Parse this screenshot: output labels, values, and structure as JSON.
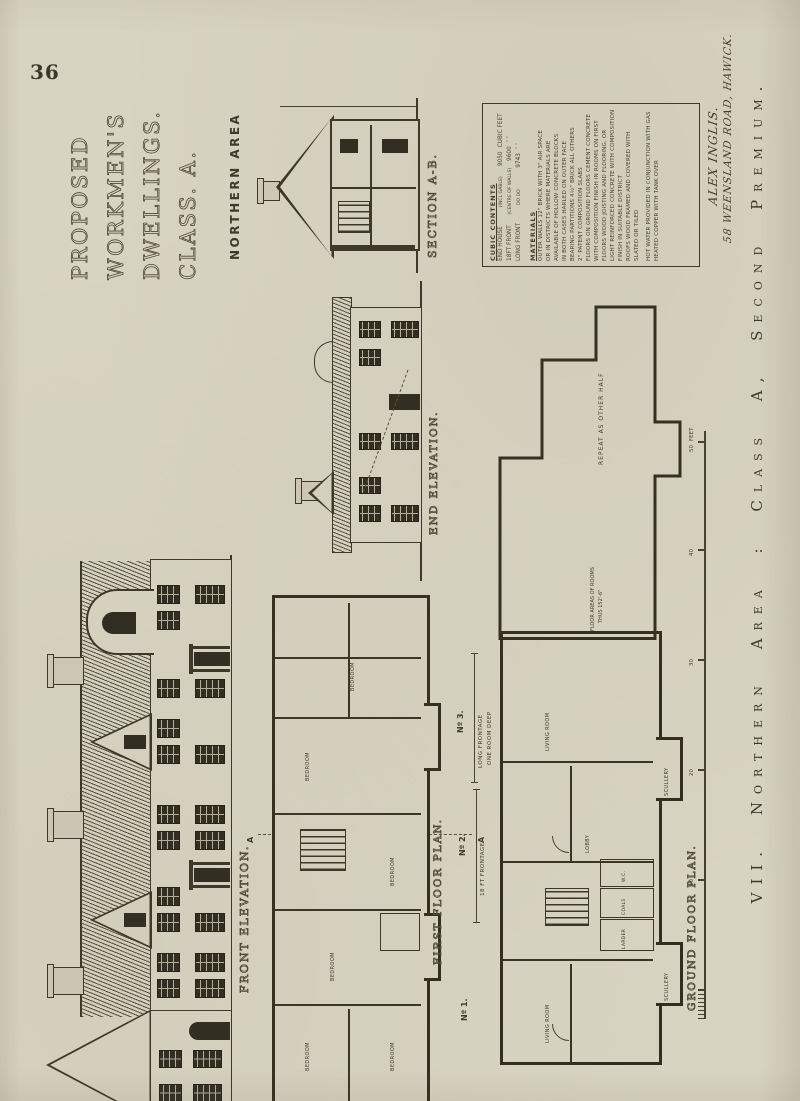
{
  "page_number": "36",
  "colors": {
    "paper": "#d8d4c2",
    "ink": "#3b3628"
  },
  "title_block": {
    "line1": "PROPOSED",
    "line2": "WORKMEN'S",
    "line3": "DWELLINGS.",
    "line4": "CLASS. A.",
    "subtitle": "NORTHERN AREA"
  },
  "labels": {
    "front_elevation": "FRONT ELEVATION.",
    "first_floor_plan": "FIRST FLOOR PLAN.",
    "ground_floor_plan": "GROUND FLOOR PLAN.",
    "end_elevation": "END ELEVATION.",
    "section": "SECTION A-B."
  },
  "house_numbers": {
    "n1": "Nº 1.",
    "n2": "Nº 2.",
    "n3": "Nº 3."
  },
  "dimensions": {
    "frontage_18": "18 FT FRONTAGE",
    "frontage_long": "LONG FRONTAGE",
    "one_room_deep": "ONE ROOM DEEP"
  },
  "plan_notes": {
    "repeat": "REPEAT AS OTHER HALF",
    "floor_areas": "FLOOR AREAS OF ROOMS",
    "floor_areas_value": "THUS 152'-6\""
  },
  "section_marker": "A",
  "rooms": {
    "first_floor": [
      "BEDROOM",
      "BEDROOM",
      "BEDROOM",
      "BEDROOM",
      "BEDROOM",
      "BEDROOM"
    ],
    "ground_floor": [
      "LIVING ROOM",
      "SCULLERY",
      "LARDER",
      "COALS",
      "W.C.",
      "LOBBY",
      "LIVING ROOM",
      "SCULLERY"
    ]
  },
  "scale_bar": {
    "t10": "10",
    "t20": "20",
    "t30": "30",
    "t40": "40",
    "t50": "50",
    "unit": "FEET"
  },
  "contents_box": {
    "cubic_heading": "CUBIC CONTENTS",
    "rows": [
      {
        "item": "END HOUSE",
        "detail": "(INCL GABLE)",
        "value": "9050",
        "unit": "CUBIC FEET"
      },
      {
        "item": "18FT FRONT",
        "detail": "(CENTRE OF WALLS)",
        "value": "9600",
        "unit": "″     ″"
      },
      {
        "item": "LONG FRONT",
        "detail": "DO      DO",
        "value": "9743",
        "unit": "″     ″"
      }
    ],
    "materials_heading": "MATERIALS",
    "materials_lines": [
      "OUTER WALLS 12\" BRICK WITH 3\" AIR SPACE",
      "OR IN DISTRICTS WHERE MATERIALS ARE",
      "AVAILABLE OF HOLLOW CONCRETE BLOCKS",
      "IN BOTH CASES HARLED ON OUTER FACE",
      "BEARING PARTITIONS 4½\" BRICK ALL OTHERS",
      "2\" PATENT COMPOSITION SLABS",
      "FLOORS ON GROUND FLOORS CEMENT CONCRETE",
      "WITH COMPOSITION FINISH IN ROOMS ON FIRST",
      "FLOORS WOOD JOISTING AND FLOORING, OR",
      "LIGHT REINFORCED CONCRETE WITH COMPOSITION",
      "FINISH IN SUITABLE DISTRICT",
      "ROOFS WOOD FRAMED AND COVERED WITH",
      "SLATED OR TILED"
    ],
    "hot_water_lines": [
      "HOT WATER PROVIDED IN CONJUNCTION WITH GAS",
      "HEATED COPPER WITH TANK OVER"
    ]
  },
  "signature": {
    "name": "ALEX INGLIS.",
    "address": "58 WEENSLAND ROAD, HAWICK."
  },
  "plate_caption": "VII. Northern Area : Class A, Second Premium."
}
